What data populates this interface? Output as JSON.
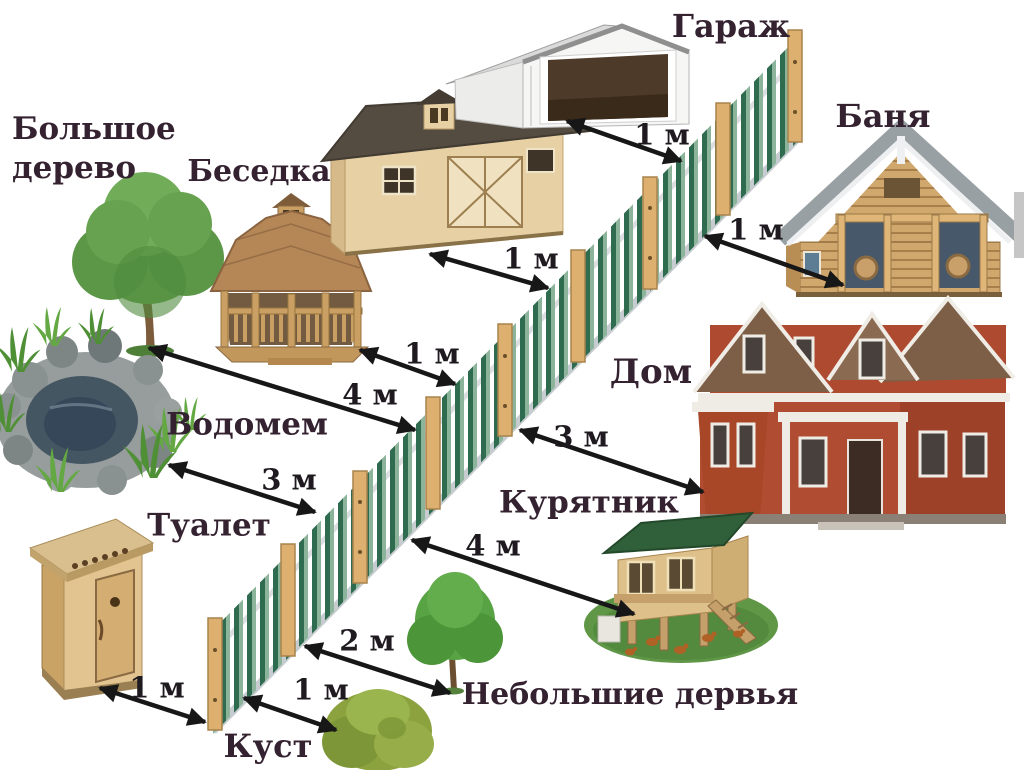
{
  "scene": {
    "background_color": "#ffffff",
    "text_color": "#342231",
    "arrow_color": "#171717",
    "fence": {
      "picket_color_dark": "#2f6b4e",
      "picket_color_light": "#8cb49a",
      "post_color": "#ddb06f",
      "rail_color": "#c6cccf"
    }
  },
  "labels": {
    "big_tree_line1": "Большое",
    "big_tree_line2": "дерево",
    "gazebo": "Беседка",
    "garage": "Гараж",
    "banya": "Баня",
    "pond": "Водомем",
    "house": "Дом",
    "toilet": "Туалет",
    "coop": "Курятник",
    "small_trees": "Небольшие дервья",
    "bush": "Куст"
  },
  "distances": {
    "garage_to_fence": "1 м",
    "shed_to_fence": "1 м",
    "banya_to_fence": "1 м",
    "gazebo_to_fence": "1 м",
    "big_tree_to_fence": "4 м",
    "pond_to_fence": "3 м",
    "house_to_fence": "3 м",
    "coop_to_fence": "4 м",
    "small_trees_to_fence": "2 м",
    "bush_to_fence": "1 м",
    "toilet_to_fence": "1 м"
  }
}
